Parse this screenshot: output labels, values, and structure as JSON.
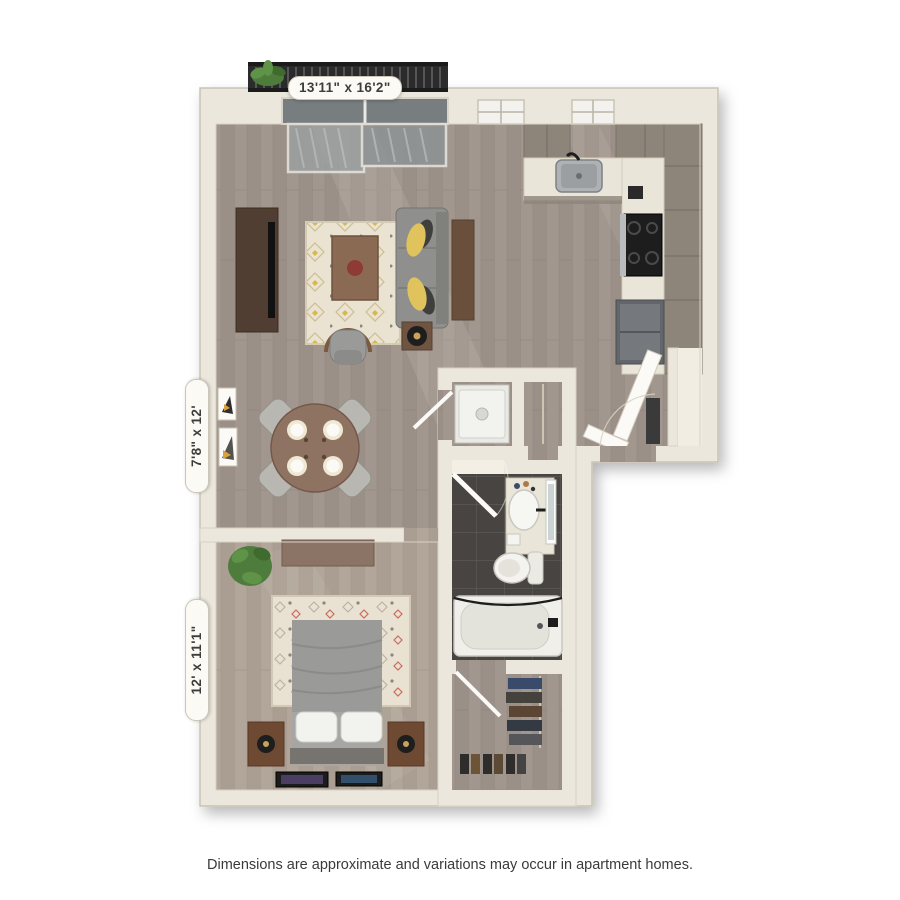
{
  "floorplan": {
    "labels": {
      "living_kitchen": "13'11\" x 16'2\"",
      "dining": "7'8\" x 12'",
      "bedroom": "12' x 11'1\""
    },
    "caption": "Dimensions are approximate and variations may occur in apartment homes.",
    "colors": {
      "wall": "#ece7dd",
      "wood_floor": "#a2978e",
      "bedroom_floor": "#b0a398",
      "bathroom_tile": "#454341",
      "counter": "#e9e5d8",
      "cabinet_wood": "#8d857a",
      "sofa_gray": "#8f8f8d",
      "accent_pillow_yellow": "#e0c35c",
      "furniture_brown": "#6f4a33",
      "rug_cream": "#eae3d2",
      "balcony_rail": "#2b2b2b",
      "plant_green": "#4e7c3c"
    }
  }
}
